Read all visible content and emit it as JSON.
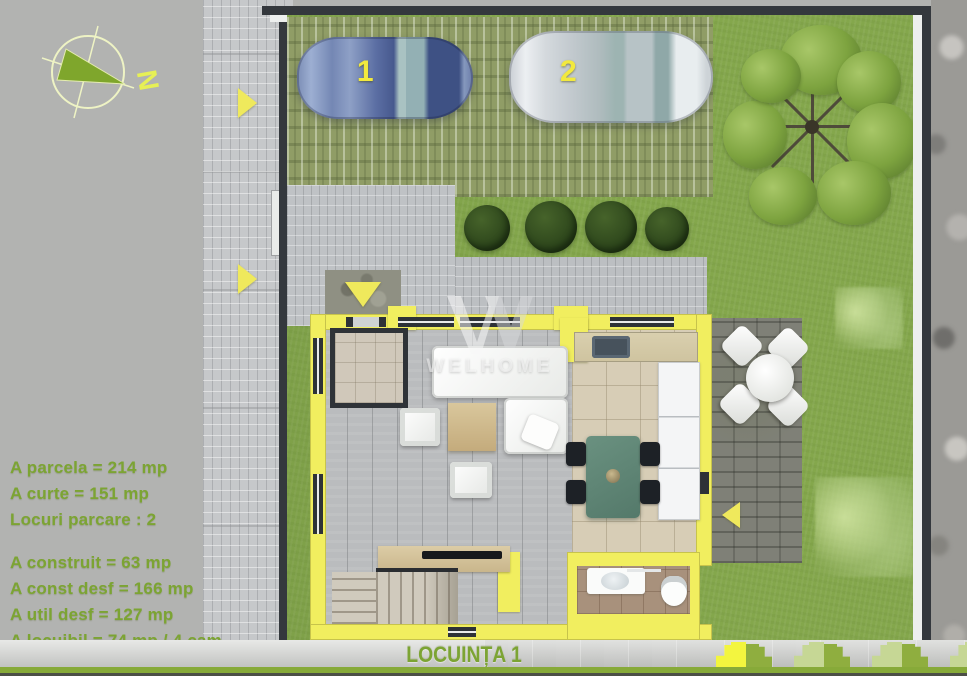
{
  "compass": {
    "north_label": "N"
  },
  "parking": {
    "cars": [
      {
        "label": "1",
        "body_color": "#5b6fa4"
      },
      {
        "label": "2",
        "body_color": "#d9dee2"
      }
    ]
  },
  "watermark": {
    "brand": "WELHOME"
  },
  "area_stats": {
    "parcel_group": [
      "A parcela = 214 mp",
      "A curte = 151 mp",
      "Locuri parcare : 2"
    ],
    "built_group": [
      "A construit = 63 mp",
      "A const desf = 166 mp",
      "A util desf = 127 mp",
      "A locuibil = 74 mp / 4 cam"
    ]
  },
  "footer": {
    "title": "LOCUINȚA 1",
    "site_key_units": [
      {
        "color": "#f3f53f",
        "highlighted": true
      },
      {
        "color": "#8fae3f",
        "highlighted": false
      },
      {
        "color": "#c6d795",
        "highlighted": false
      },
      {
        "color": "#8fae3f",
        "highlighted": false
      },
      {
        "color": "#c6d795",
        "highlighted": false
      },
      {
        "color": "#8fae3f",
        "highlighted": false
      },
      {
        "color": "#c6d795",
        "highlighted": false
      }
    ]
  },
  "colors": {
    "stats_text": "#7ca433",
    "footer_text": "#7ca433",
    "footer_strip": "#87aa39",
    "house_wall": "#f1ee5f",
    "lawn": "#84a74c",
    "accent_arrow": "#efe95c",
    "car_label": "#f2e93e",
    "fence": "#34383d"
  }
}
